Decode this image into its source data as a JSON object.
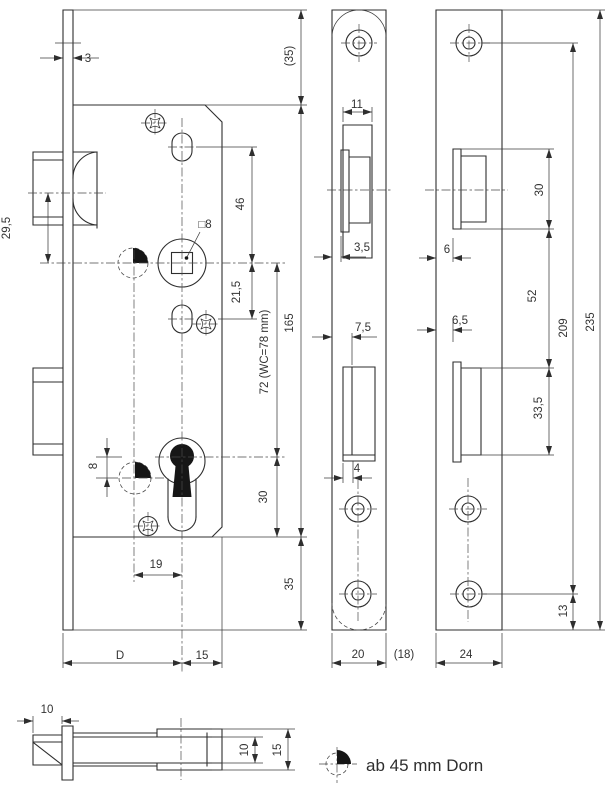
{
  "views": {
    "lock_body": {
      "dims": {
        "faceplate_thickness": "3",
        "top_margin": "(35)",
        "latch_to_follower": "29,5",
        "follower_to_upper_slot": "46",
        "follower_square_hole": "□8",
        "follower_to_lower_slot": "21,5",
        "case_height": "165",
        "follower_to_cylinder": "72 (WC=78 mm)",
        "cylinder_to_case_bottom": "30",
        "bottom_margin": "35",
        "cylinder_offset": "8",
        "marker_to_cylinder_axis": "19",
        "backset": "D",
        "cylinder_axis_to_case_back": "15"
      }
    },
    "faceplate_front": {
      "dims": {
        "latch_width": "11",
        "latch_bevel_offset": "3,5",
        "deadbolt_face_offset": "7,5",
        "deadbolt_inset": "4",
        "plate_width": "20",
        "plate_width_alt": "(18)"
      }
    },
    "strike_plate": {
      "dims": {
        "latch_cutout_height": "30",
        "latch_lip_offset": "6",
        "cutout_gap": "52",
        "deadbolt_lip_offset": "6,5",
        "deadbolt_cutout_height": "33,5",
        "screw_hole_spacing": "209",
        "plate_length": "235",
        "screw_to_bottom_edge": "13",
        "plate_width": "24"
      }
    },
    "latch_bolt_detail": {
      "dims": {
        "head_protrusion": "10",
        "bolt_height": "10",
        "guide_height": "15"
      }
    }
  },
  "note": {
    "backset_note": "ab 45 mm Dorn"
  }
}
